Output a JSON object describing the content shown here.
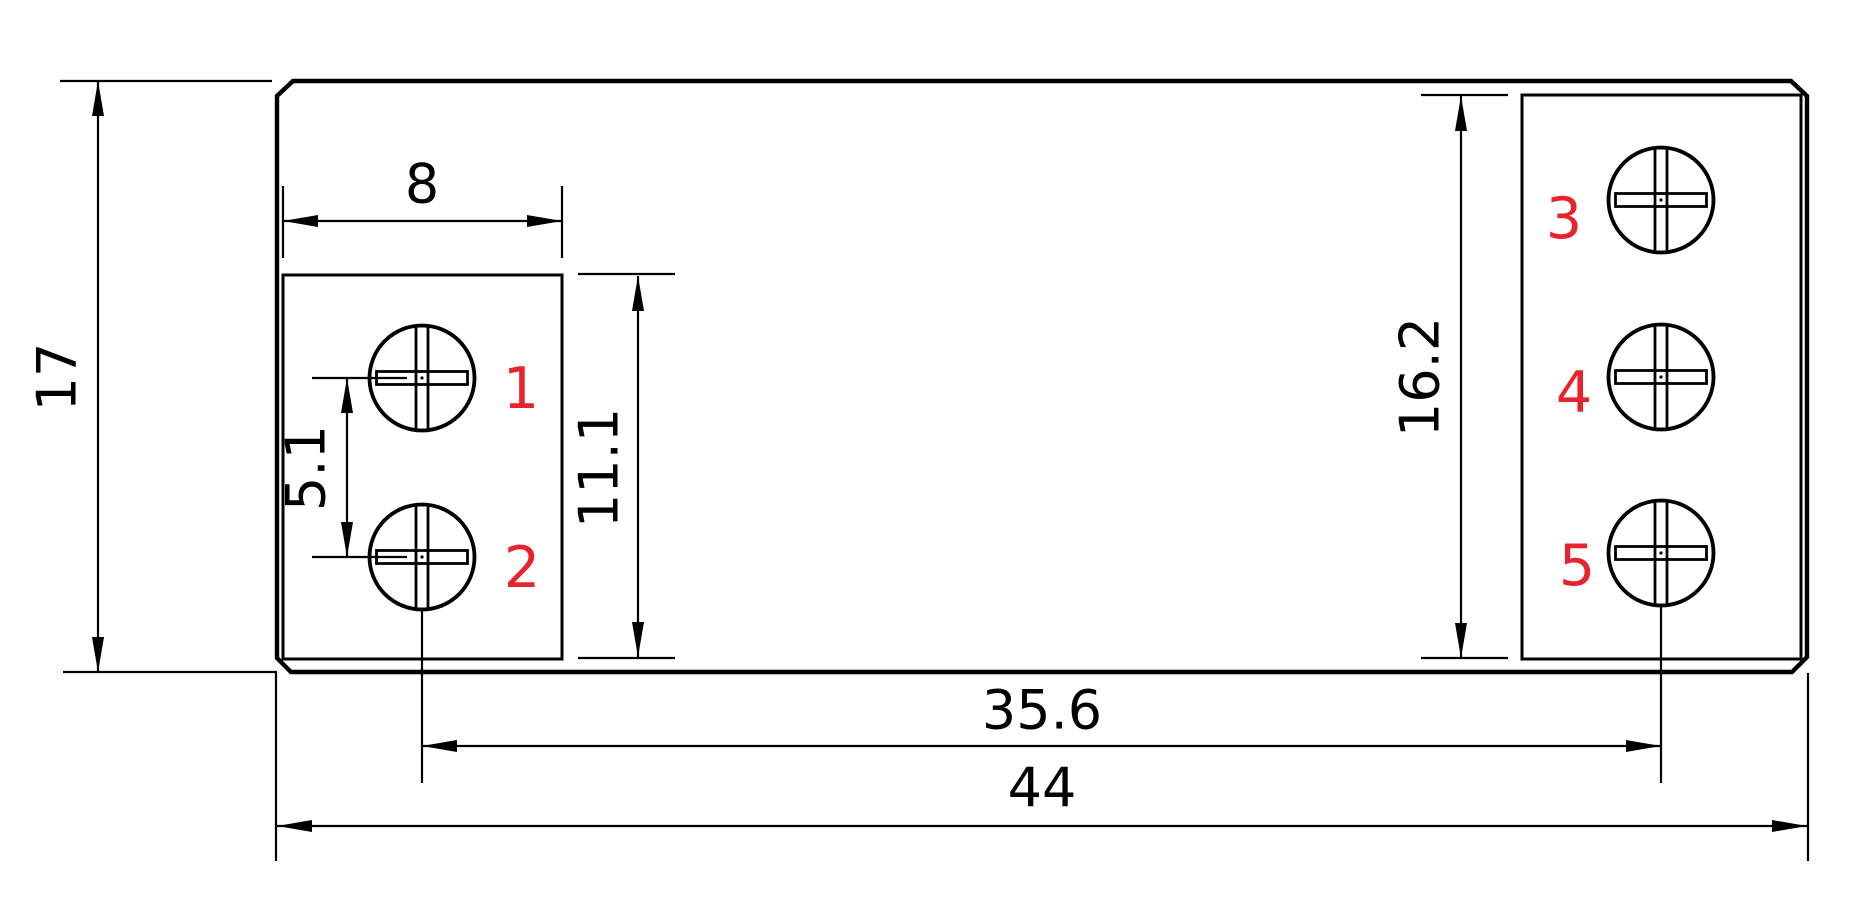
{
  "drawing": {
    "dimensions": {
      "overall_height": "17",
      "left_block_width": "8",
      "screw_pitch": "5.1",
      "left_block_height": "11.1",
      "right_block_height": "16.2",
      "screw_span": "35.6",
      "overall_width": "44"
    },
    "terminal_labels": [
      "1",
      "2",
      "3",
      "4",
      "5"
    ],
    "colors": {
      "line": "#000000",
      "dimension_text": "#000000",
      "terminal_label": "#e8232b",
      "background": "#ffffff"
    }
  }
}
